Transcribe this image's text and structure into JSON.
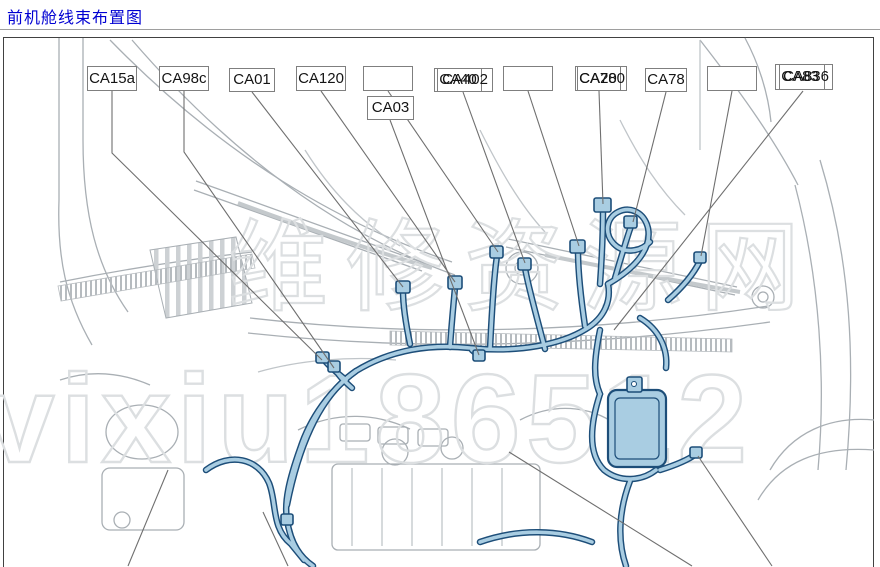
{
  "page": {
    "title": "前机舱线束布置图"
  },
  "watermark": {
    "line1": "维修资源网",
    "line2": "vixiu186512"
  },
  "labels": {
    "ca15a": "CA15a",
    "ca98c": "CA98c",
    "ca01": "CA01",
    "ca120": "CA120",
    "blank1": "",
    "ca03": "CA03",
    "ca40": "CA40",
    "ca402": "CA402",
    "blank2": "",
    "ca20": "CA20",
    "ca780": "CA780",
    "ca78": "CA78",
    "blank3": "",
    "ca83": "CA83",
    "ca836": "CA836"
  },
  "colors": {
    "title_text": "#0000d2",
    "frame_border": "#414141",
    "label_border": "#7f7f7f",
    "leader_line": "#6f6f6f",
    "line_art": "#a9afb4",
    "harness_fill": "#a9cde2",
    "harness_outline": "#1d4e79",
    "watermark": "#dcdfe1"
  }
}
